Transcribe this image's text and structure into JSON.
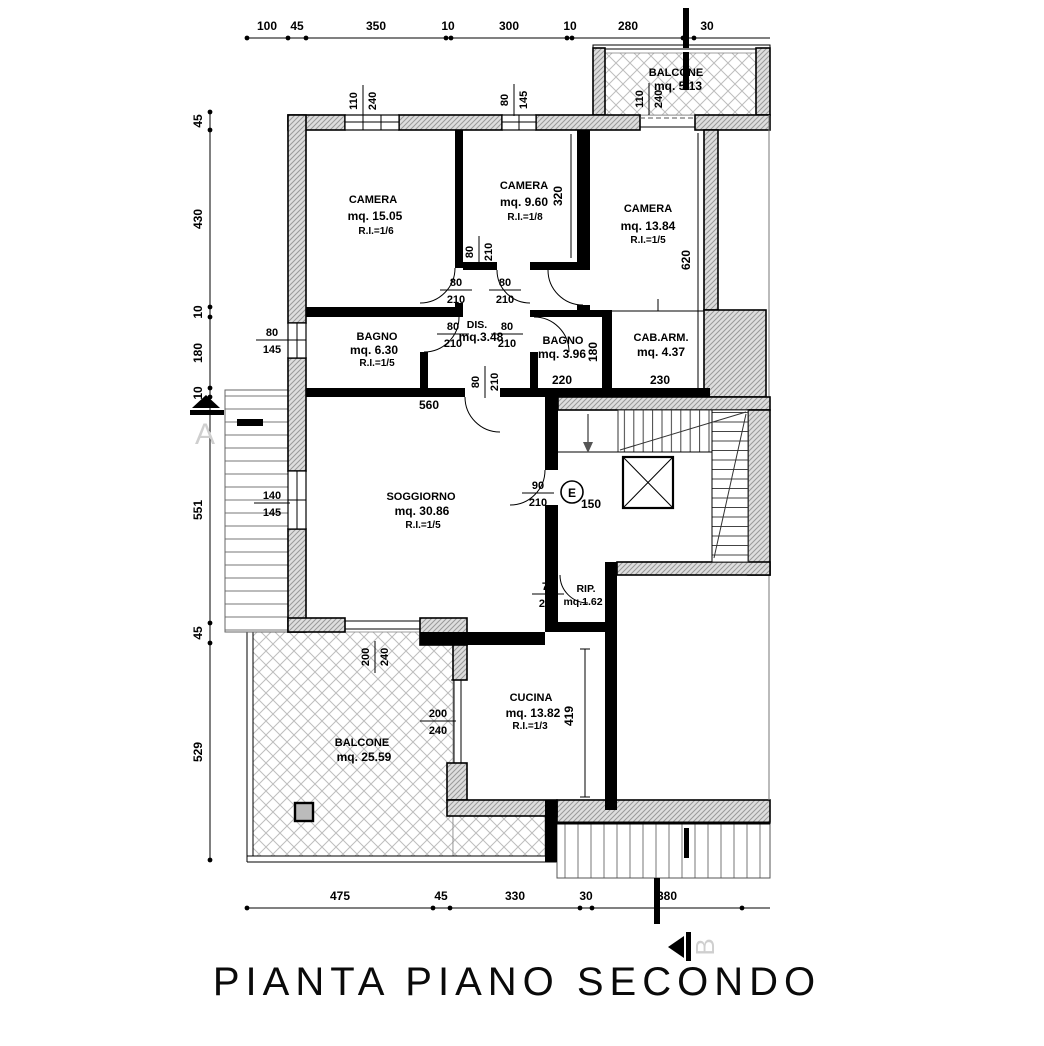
{
  "title": "PIANTA PIANO SECONDO",
  "rooms": {
    "camera1": {
      "name": "CAMERA",
      "area": "mq. 15.05",
      "ri": "R.I.=1/6"
    },
    "camera2": {
      "name": "CAMERA",
      "area": "mq. 9.60",
      "ri": "R.I.=1/8"
    },
    "camera3": {
      "name": "CAMERA",
      "area": "mq. 13.84",
      "ri": "R.I.=1/5"
    },
    "bagno1": {
      "name": "BAGNO",
      "area": "mq. 6.30",
      "ri": "R.I.=1/5"
    },
    "dis": {
      "name": "DIS.",
      "area": "mq.3.48"
    },
    "bagno2": {
      "name": "BAGNO",
      "area": "mq. 3.96"
    },
    "cabarm": {
      "name": "CAB.ARM.",
      "area": "mq. 4.37"
    },
    "soggiorno": {
      "name": "SOGGIORNO",
      "area": "mq. 30.86",
      "ri": "R.I.=1/5"
    },
    "rip": {
      "name": "RIP.",
      "area": "mq.1.62"
    },
    "cucina": {
      "name": "CUCINA",
      "area": "mq. 13.82",
      "ri": "R.I.=1/3"
    },
    "balcone1": {
      "name": "BALCONE",
      "area": "mq. 25.59"
    },
    "balcone2": {
      "name": "BALCONE",
      "area": "mq. 5.13"
    }
  },
  "dims": {
    "top": [
      "100",
      "45",
      "350",
      "10",
      "300",
      "10",
      "280",
      "30"
    ],
    "left": [
      "45",
      "430",
      "10",
      "180",
      "10",
      "551",
      "45",
      "529"
    ],
    "bottom": [
      "475",
      "45",
      "330",
      "30",
      "380"
    ],
    "camera2_depth": "320",
    "camera3_depth": "620",
    "bagno2_depth": "180",
    "bagno2_width": "220",
    "cabarm_width": "230",
    "soggiorno_width": "560",
    "landing": "150",
    "cucina_depth": "419"
  },
  "openings": {
    "win_camera1": {
      "w": "110",
      "h": "240"
    },
    "win_camera2": {
      "w": "80",
      "h": "145"
    },
    "door_balcone2": {
      "w": "110",
      "h": "240"
    },
    "win_bagno1": {
      "w": "80",
      "h": "145"
    },
    "win_soggiorno": {
      "w": "140",
      "h": "145"
    },
    "door_sogg_balcone": {
      "w": "200",
      "h": "240"
    },
    "win_cucina": {
      "w": "200",
      "h": "240"
    },
    "door_std": {
      "w": "80",
      "h": "210"
    },
    "door_soggiorno": {
      "w": "90",
      "h": "210"
    },
    "door_rip": {
      "w": "70",
      "h": "210"
    }
  },
  "markers": {
    "section_a": "A",
    "section_b": "B",
    "elevator": "E"
  },
  "colors": {
    "wall_fill": "#dedede",
    "hatch": "#999999",
    "lattice": "#bdbdbd",
    "ink": "#000000",
    "muted": "#cfcfcf"
  }
}
